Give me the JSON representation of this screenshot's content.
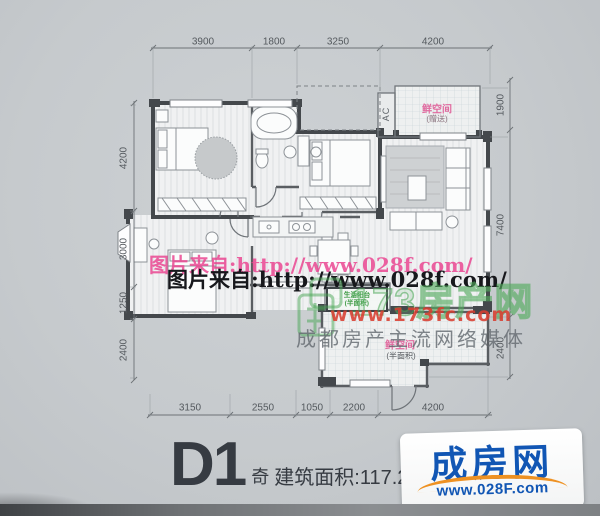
{
  "watermarks": {
    "pink_url": "图片来自:http://www.028f.com/",
    "black_url": "图片来自:http://www.028f.com/",
    "site_name": "173房产网",
    "site_url": "www.173fc.com",
    "slogan": "成都房产主流网络媒体"
  },
  "plan": {
    "labels": {
      "ac": "AC",
      "gift_top_name": "鲜空间",
      "gift_top_note": "(赠送)",
      "service_balcony_name": "生活阳台",
      "service_balcony_note": "(半面积)",
      "gift_bottom_name": "鲜空间",
      "gift_bottom_note": "(半面积)"
    },
    "dims": {
      "top": [
        "3900",
        "1800",
        "3250",
        "4200"
      ],
      "left": [
        "4200",
        "3000",
        "1250",
        "2400"
      ],
      "right": [
        "1900",
        "7400",
        "2400"
      ],
      "bottom": [
        "3150",
        "2550",
        "1050",
        "2200",
        "4200"
      ]
    }
  },
  "footer": {
    "unit": "D1",
    "floor_parity": "奇",
    "area": "建筑面积:117.21",
    "logo_name": "成房网",
    "logo_url": "www.028F.com"
  },
  "colors": {
    "watermark_pink": "#e8408d",
    "watermark_green": "#48a654",
    "watermark_red": "#d83e30",
    "logo_blue": "#1156b4",
    "logo_orange": "#ee9122"
  }
}
